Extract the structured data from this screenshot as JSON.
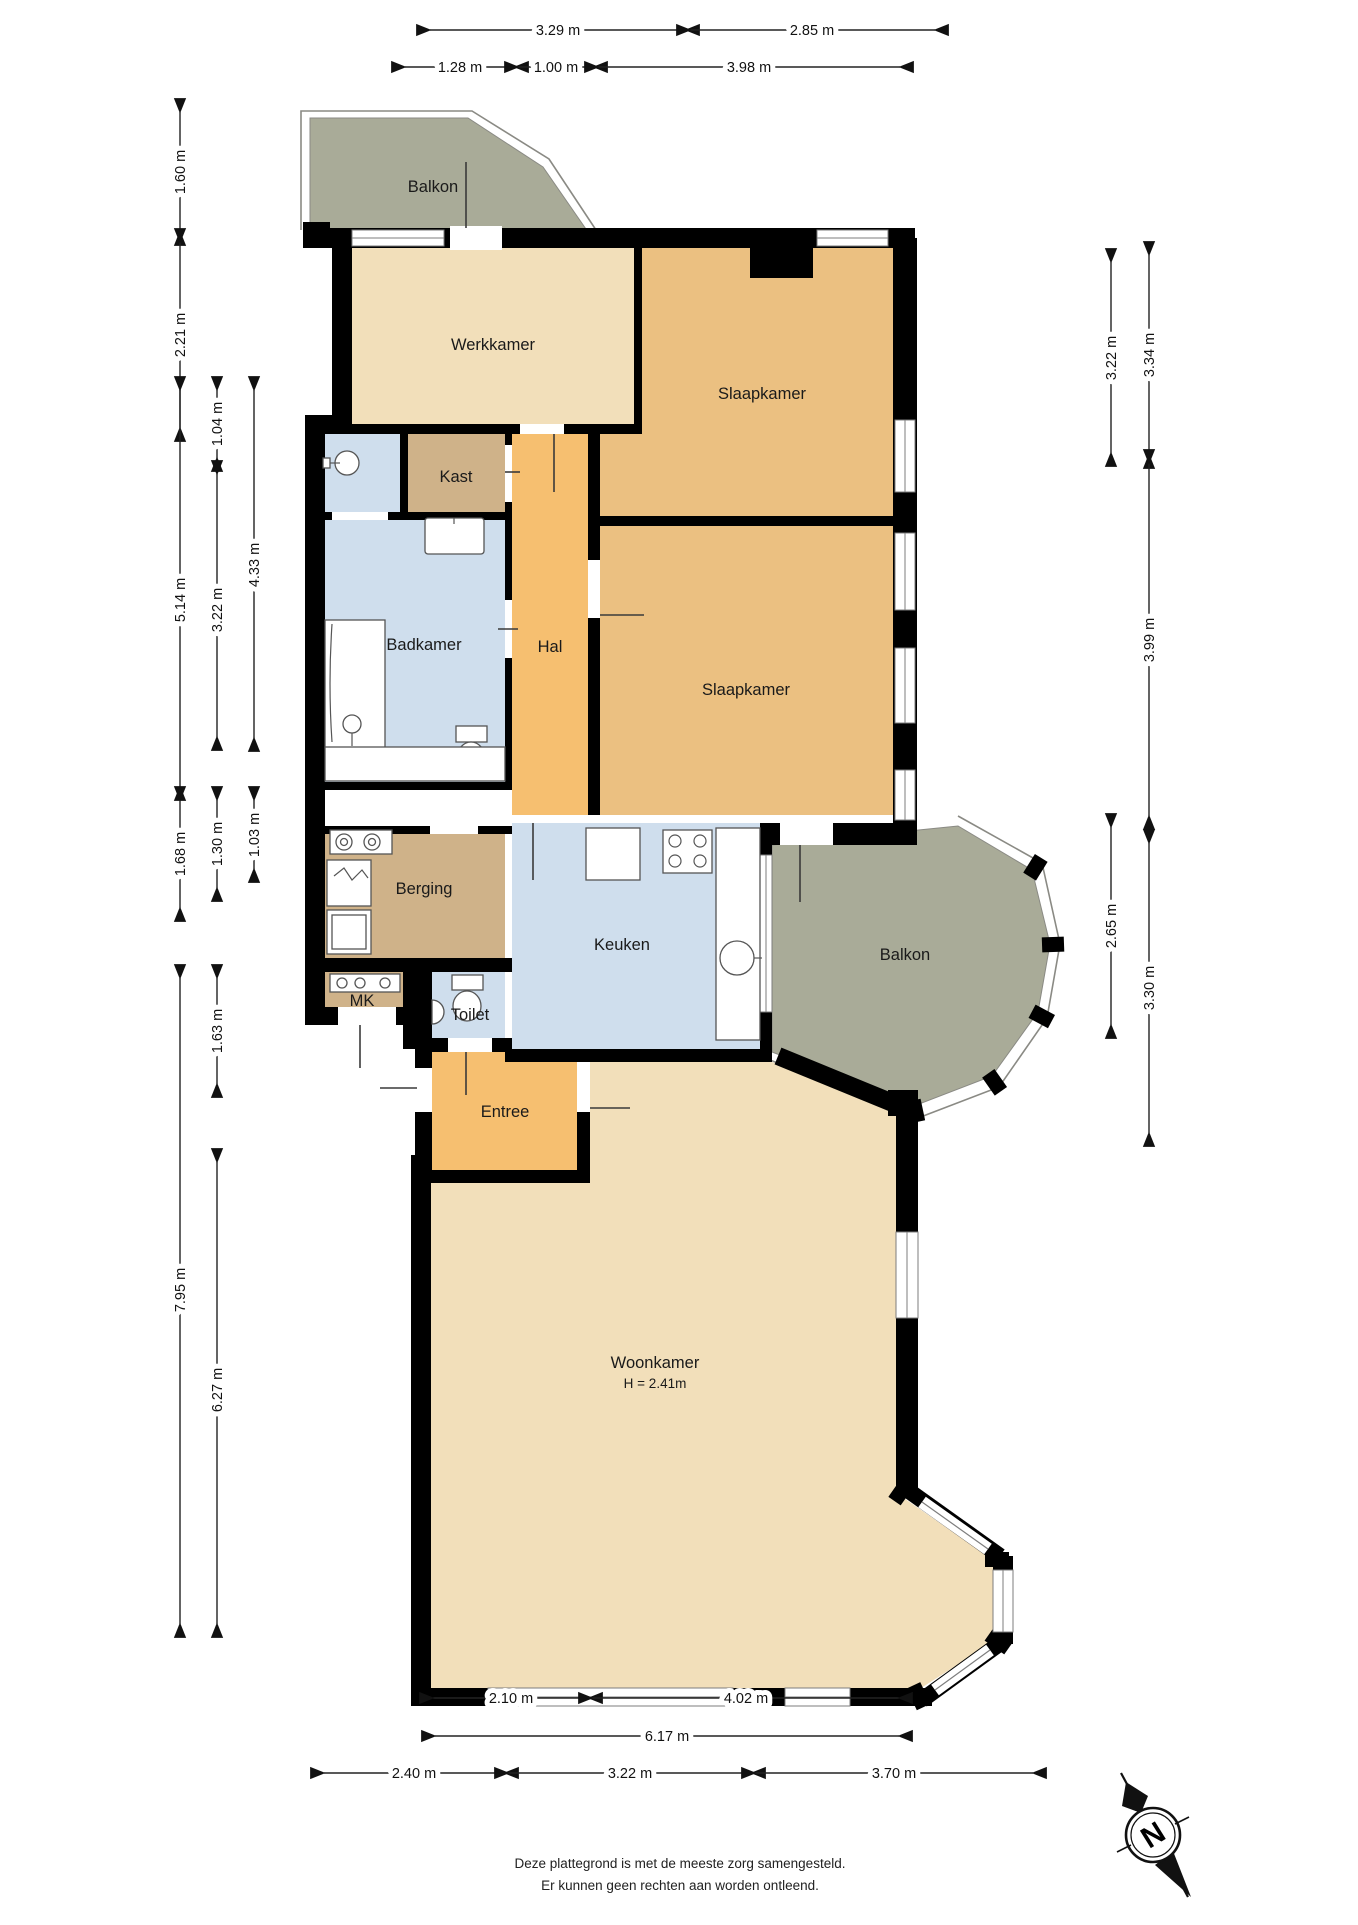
{
  "rooms": {
    "balkon_top": {
      "label": "Balkon"
    },
    "werkkamer": {
      "label": "Werkkamer"
    },
    "slaapkamer1": {
      "label": "Slaapkamer"
    },
    "kast": {
      "label": "Kast"
    },
    "badkamer": {
      "label": "Badkamer"
    },
    "hal": {
      "label": "Hal"
    },
    "slaapkamer2": {
      "label": "Slaapkamer"
    },
    "berging": {
      "label": "Berging"
    },
    "mk": {
      "label": "MK"
    },
    "toilet": {
      "label": "Toilet"
    },
    "keuken": {
      "label": "Keuken"
    },
    "entree": {
      "label": "Entree"
    },
    "balkon_right": {
      "label": "Balkon"
    },
    "woonkamer": {
      "label": "Woonkamer",
      "height_label": "H = 2.41m"
    }
  },
  "dimensions": {
    "top_row1": [
      {
        "label": "3.29 m"
      },
      {
        "label": "2.85 m"
      }
    ],
    "top_row2": [
      {
        "label": "1.28 m"
      },
      {
        "label": "1.00 m"
      },
      {
        "label": "3.98 m"
      }
    ],
    "left": [
      {
        "label": "1.60 m"
      },
      {
        "label": "2.21 m"
      },
      {
        "label": "5.14 m"
      },
      {
        "label": "1.68 m"
      },
      {
        "label": "7.95 m"
      },
      {
        "label": "1.04 m"
      },
      {
        "label": "3.22 m"
      },
      {
        "label": "1.30 m"
      },
      {
        "label": "1.63 m"
      },
      {
        "label": "6.27 m"
      },
      {
        "label": "4.33 m"
      },
      {
        "label": "1.03 m"
      }
    ],
    "right": [
      {
        "label": "3.22 m"
      },
      {
        "label": "3.34 m"
      },
      {
        "label": "3.99 m"
      },
      {
        "label": "2.65 m"
      },
      {
        "label": "3.30 m"
      }
    ],
    "bottom_row1": [
      {
        "label": "2.10 m"
      },
      {
        "label": "4.02 m"
      }
    ],
    "bottom_row2": [
      {
        "label": "6.17 m"
      }
    ],
    "bottom_row3": [
      {
        "label": "2.40 m"
      },
      {
        "label": "3.22 m"
      },
      {
        "label": "3.70 m"
      }
    ]
  },
  "compass": {
    "label": "N"
  },
  "disclaimer": {
    "line1": "Deze plattegrond is met de meeste zorg samengesteld.",
    "line2": "Er kunnen geen rechten aan worden ontleend."
  },
  "colors": {
    "wall": "#000000",
    "cream": "#f2dfba",
    "tan": "#ebc081",
    "orange": "#f6bf70",
    "brown": "#cfb289",
    "blue": "#cfdeed",
    "grey_green": "#a9ab98",
    "railing": "#8a8a84"
  }
}
